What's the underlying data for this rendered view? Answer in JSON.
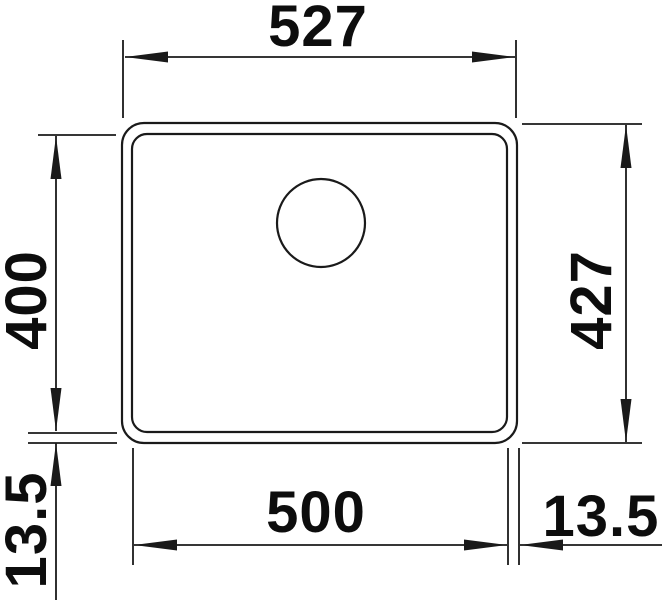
{
  "colors": {
    "background": "#ffffff",
    "line": "#1a1a1a",
    "text": "#0d0d0d"
  },
  "drawing": {
    "kind": "dimensioned technical drawing of a rectangular sink bowl, top view",
    "dimensions": {
      "top_width": "527",
      "left_inner_height": "400",
      "right_outer_height": "427",
      "bottom_inner_width": "500",
      "bottom_left_rim": "13.5",
      "bottom_right_rim": "13.5"
    }
  }
}
